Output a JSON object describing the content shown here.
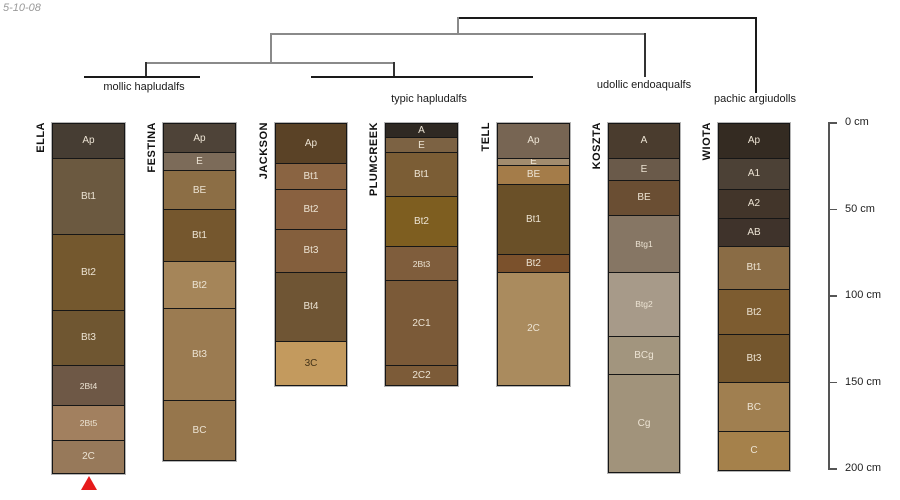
{
  "note": "5-10-08",
  "dendrogram": {
    "lines": [
      {
        "x1": 457,
        "y1": 17,
        "x2": 755,
        "y2": 17,
        "color": "#1a1a1a"
      },
      {
        "x1": 755,
        "y1": 17,
        "x2": 755,
        "y2": 93,
        "color": "#1a1a1a"
      },
      {
        "x1": 457,
        "y1": 17,
        "x2": 457,
        "y2": 33,
        "color": "#8a8a8a"
      },
      {
        "x1": 270,
        "y1": 33,
        "x2": 644,
        "y2": 33,
        "color": "#8a8a8a"
      },
      {
        "x1": 644,
        "y1": 33,
        "x2": 644,
        "y2": 77,
        "color": "#333333"
      },
      {
        "x1": 270,
        "y1": 33,
        "x2": 270,
        "y2": 62,
        "color": "#8a8a8a"
      },
      {
        "x1": 145,
        "y1": 62,
        "x2": 395,
        "y2": 62,
        "color": "#8a8a8a"
      },
      {
        "x1": 145,
        "y1": 62,
        "x2": 145,
        "y2": 76,
        "color": "#333333"
      },
      {
        "x1": 84,
        "y1": 76,
        "x2": 200,
        "y2": 76,
        "color": "#1a1a1a"
      },
      {
        "x1": 393,
        "y1": 62,
        "x2": 393,
        "y2": 76,
        "color": "#333333"
      },
      {
        "x1": 311,
        "y1": 76,
        "x2": 533,
        "y2": 76,
        "color": "#1a1a1a"
      }
    ],
    "labels": [
      {
        "text": "mollic hapludalfs",
        "cx": 144,
        "top": 81
      },
      {
        "text": "typic hapludalfs",
        "cx": 429,
        "top": 93
      },
      {
        "text": "udollic endoaqualfs",
        "cx": 644,
        "top": 79
      },
      {
        "text": "pachic argiudolls",
        "cx": 755,
        "top": 93
      }
    ]
  },
  "scale": {
    "origin_y": 123,
    "px_per_cm": 1.73,
    "axis_x": 828,
    "tick_len": 9,
    "label_x": 845,
    "ticks": [
      {
        "cm": 0,
        "label": "0 cm"
      },
      {
        "cm": 50,
        "label": "50 cm"
      },
      {
        "cm": 100,
        "label": "100 cm"
      },
      {
        "cm": 150,
        "label": "150 cm"
      },
      {
        "cm": 200,
        "label": "200 cm"
      }
    ]
  },
  "marker": {
    "symbol": "triangle-up",
    "color": "#e61a1b"
  },
  "series": [
    {
      "name": "ELLA",
      "x": 52,
      "width": 73,
      "marker_below": true,
      "horizons": [
        {
          "label": "Ap",
          "bottom_cm": 20,
          "color": "#463d33"
        },
        {
          "label": "Bt1",
          "bottom_cm": 64,
          "color": "#6b5940"
        },
        {
          "label": "Bt2",
          "bottom_cm": 108,
          "color": "#74582e"
        },
        {
          "label": "Bt3",
          "bottom_cm": 140,
          "color": "#6f5631"
        },
        {
          "label": "2Bt4",
          "bottom_cm": 163,
          "color": "#6e5846",
          "small": true
        },
        {
          "label": "2Bt5",
          "bottom_cm": 183,
          "color": "#a2805f",
          "small": true
        },
        {
          "label": "2C",
          "bottom_cm": 202,
          "color": "#97795a"
        }
      ]
    },
    {
      "name": "FESTINA",
      "x": 163,
      "width": 73,
      "horizons": [
        {
          "label": "Ap",
          "bottom_cm": 17,
          "color": "#4e4338"
        },
        {
          "label": "E",
          "bottom_cm": 27,
          "color": "#7c6b59"
        },
        {
          "label": "BE",
          "bottom_cm": 50,
          "color": "#8c6e45"
        },
        {
          "label": "Bt1",
          "bottom_cm": 80,
          "color": "#75572e"
        },
        {
          "label": "Bt2",
          "bottom_cm": 107,
          "color": "#a58559"
        },
        {
          "label": "Bt3",
          "bottom_cm": 160,
          "color": "#9b7b51"
        },
        {
          "label": "BC",
          "bottom_cm": 194,
          "color": "#96764c"
        }
      ]
    },
    {
      "name": "JACKSON",
      "x": 275,
      "width": 72,
      "horizons": [
        {
          "label": "Ap",
          "bottom_cm": 23,
          "color": "#5a4226"
        },
        {
          "label": "Bt1",
          "bottom_cm": 38,
          "color": "#8a6442"
        },
        {
          "label": "Bt2",
          "bottom_cm": 61,
          "color": "#896140"
        },
        {
          "label": "Bt3",
          "bottom_cm": 86,
          "color": "#845f3d"
        },
        {
          "label": "Bt4",
          "bottom_cm": 126,
          "color": "#6f5534"
        },
        {
          "label": "3C",
          "bottom_cm": 151,
          "color": "#c39a5e",
          "text_color": "#443318"
        }
      ]
    },
    {
      "name": "PLUMCREEK",
      "x": 385,
      "width": 73,
      "horizons": [
        {
          "label": "A",
          "bottom_cm": 8,
          "color": "#2f2923"
        },
        {
          "label": "E",
          "bottom_cm": 17,
          "color": "#7c6243"
        },
        {
          "label": "Bt1",
          "bottom_cm": 42,
          "color": "#7b5d35"
        },
        {
          "label": "Bt2",
          "bottom_cm": 71,
          "color": "#7e5e20"
        },
        {
          "label": "2Bt3",
          "bottom_cm": 91,
          "color": "#7f5d3c",
          "small": true
        },
        {
          "label": "2C1",
          "bottom_cm": 140,
          "color": "#7b5a38"
        },
        {
          "label": "2C2",
          "bottom_cm": 151,
          "color": "#7c5b38"
        }
      ]
    },
    {
      "name": "TELL",
      "x": 497,
      "width": 73,
      "horizons": [
        {
          "label": "Ap",
          "bottom_cm": 20,
          "color": "#776553"
        },
        {
          "label": "E",
          "bottom_cm": 24,
          "color": "#a28c6e"
        },
        {
          "label": "BE",
          "bottom_cm": 35,
          "color": "#a47c49"
        },
        {
          "label": "Bt1",
          "bottom_cm": 76,
          "color": "#6a5028"
        },
        {
          "label": "Bt2",
          "bottom_cm": 86,
          "color": "#7b512c"
        },
        {
          "label": "2C",
          "bottom_cm": 151,
          "color": "#aa8b5e"
        }
      ]
    },
    {
      "name": "KOSZTA",
      "x": 608,
      "width": 72,
      "horizons": [
        {
          "label": "A",
          "bottom_cm": 20,
          "color": "#4a3c2e"
        },
        {
          "label": "E",
          "bottom_cm": 33,
          "color": "#6a5a4a"
        },
        {
          "label": "BE",
          "bottom_cm": 53,
          "color": "#6a4e33"
        },
        {
          "label": "Btg1",
          "bottom_cm": 86,
          "color": "#867664",
          "small": true
        },
        {
          "label": "Btg2",
          "bottom_cm": 123,
          "color": "#a79a89",
          "small": true
        },
        {
          "label": "BCg",
          "bottom_cm": 145,
          "color": "#a2957e"
        },
        {
          "label": "Cg",
          "bottom_cm": 201,
          "color": "#a1937b"
        }
      ]
    },
    {
      "name": "WIOTA",
      "x": 718,
      "width": 72,
      "horizons": [
        {
          "label": "Ap",
          "bottom_cm": 20,
          "color": "#342b22"
        },
        {
          "label": "A1",
          "bottom_cm": 38,
          "color": "#4c4136"
        },
        {
          "label": "A2",
          "bottom_cm": 55,
          "color": "#42352a"
        },
        {
          "label": "AB",
          "bottom_cm": 71,
          "color": "#3f332b"
        },
        {
          "label": "Bt1",
          "bottom_cm": 96,
          "color": "#8a6c45"
        },
        {
          "label": "Bt2",
          "bottom_cm": 122,
          "color": "#7d5c30"
        },
        {
          "label": "Bt3",
          "bottom_cm": 150,
          "color": "#74562d"
        },
        {
          "label": "BC",
          "bottom_cm": 178,
          "color": "#a07f50"
        },
        {
          "label": "C",
          "bottom_cm": 200,
          "color": "#a5814b"
        }
      ]
    }
  ]
}
